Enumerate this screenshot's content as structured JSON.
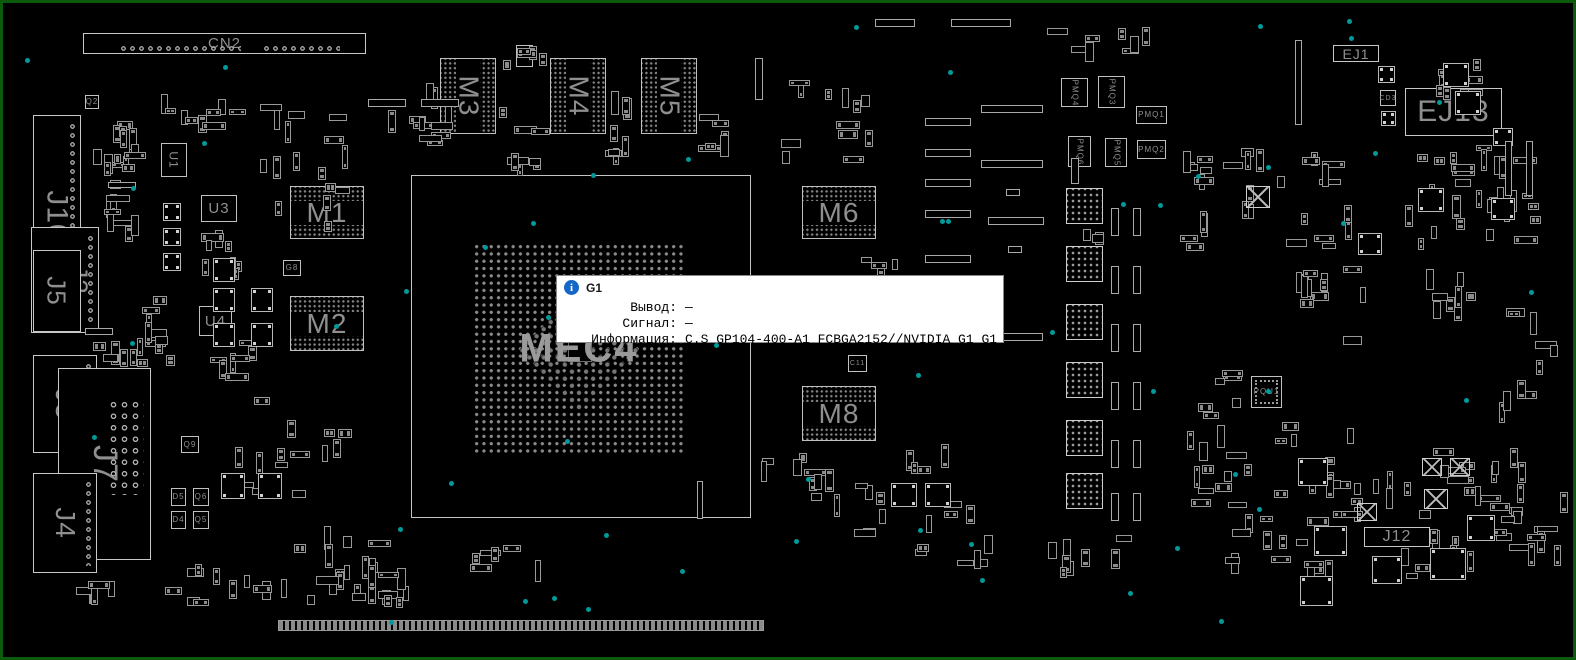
{
  "window": {
    "background": "#000000",
    "border_color": "#0c5a0c",
    "outline_color": "#b8b8b8",
    "label_color": "#8f8f8f",
    "testpoint_color": "#009a9a"
  },
  "tooltip": {
    "icon": "info-icon",
    "icon_glyph": "i",
    "icon_color": "#1467c6",
    "component": "G1",
    "rows": [
      {
        "label": "Вывод:",
        "value": "—"
      },
      {
        "label": "Сигнал:",
        "value": "—"
      },
      {
        "label": "Информация:",
        "value": "C.S GP104-400-A1 FCBGA2152//NVIDIA G1 G1"
      }
    ]
  },
  "gpu": {
    "ref": "G1",
    "die_label": "MEC4"
  },
  "components": [
    {
      "id": "CN2",
      "label": "CN2",
      "type": "connector",
      "x": 80,
      "y": 30,
      "w": 283,
      "h": 21,
      "fs": 15,
      "pins": "cn2"
    },
    {
      "id": "J10",
      "label": "J10",
      "type": "connector-v",
      "x": 30,
      "y": 112,
      "w": 48,
      "h": 202,
      "fs": 30,
      "pincol": 1
    },
    {
      "id": "J2",
      "label": "J2",
      "type": "connector-v",
      "x": 28,
      "y": 224,
      "w": 68,
      "h": 106,
      "fs": 26,
      "dx": 14,
      "pincol": 1
    },
    {
      "id": "J5",
      "label": "J5",
      "type": "connector-v",
      "x": 30,
      "y": 247,
      "w": 48,
      "h": 82,
      "fs": 26
    },
    {
      "id": "J3",
      "label": "J3",
      "type": "connector-v",
      "x": 30,
      "y": 352,
      "w": 64,
      "h": 98,
      "fs": 28,
      "pincol": 1
    },
    {
      "id": "J7",
      "label": "J7",
      "type": "connector-v",
      "x": 55,
      "y": 365,
      "w": 93,
      "h": 192,
      "fs": 34,
      "pingrid": 1
    },
    {
      "id": "J4",
      "label": "J4",
      "type": "connector-v",
      "x": 30,
      "y": 470,
      "w": 64,
      "h": 100,
      "fs": 28,
      "pincol": 1
    },
    {
      "id": "U1",
      "label": "U1",
      "type": "chip-v",
      "x": 158,
      "y": 140,
      "w": 26,
      "h": 34,
      "fs": 12
    },
    {
      "id": "U3",
      "label": "U3",
      "type": "chip",
      "x": 198,
      "y": 192,
      "w": 36,
      "h": 27,
      "fs": 15
    },
    {
      "id": "U4",
      "label": "U4",
      "type": "chip",
      "x": 196,
      "y": 303,
      "w": 33,
      "h": 30,
      "fs": 15
    },
    {
      "id": "M1",
      "label": "M1",
      "type": "bga",
      "x": 287,
      "y": 183,
      "w": 74,
      "h": 53,
      "fs": 28
    },
    {
      "id": "M2",
      "label": "M2",
      "type": "bga",
      "x": 287,
      "y": 293,
      "w": 74,
      "h": 55,
      "fs": 28
    },
    {
      "id": "M3",
      "label": "M3",
      "type": "bga-v",
      "x": 437,
      "y": 55,
      "w": 56,
      "h": 76,
      "fs": 28
    },
    {
      "id": "M4",
      "label": "M4",
      "type": "bga-v",
      "x": 547,
      "y": 55,
      "w": 56,
      "h": 76,
      "fs": 28
    },
    {
      "id": "M5",
      "label": "M5",
      "type": "bga-v",
      "x": 638,
      "y": 55,
      "w": 56,
      "h": 76,
      "fs": 28
    },
    {
      "id": "M6",
      "label": "M6",
      "type": "bga",
      "x": 799,
      "y": 183,
      "w": 74,
      "h": 53,
      "fs": 28
    },
    {
      "id": "M8",
      "label": "M8",
      "type": "bga",
      "x": 799,
      "y": 383,
      "w": 74,
      "h": 55,
      "fs": 28
    },
    {
      "id": "EJ1",
      "label": "EJ1",
      "type": "connector",
      "x": 1330,
      "y": 42,
      "w": 46,
      "h": 17,
      "fs": 14
    },
    {
      "id": "EJ13",
      "label": "EJ13",
      "type": "connector",
      "x": 1402,
      "y": 85,
      "w": 97,
      "h": 48,
      "fs": 30
    },
    {
      "id": "J12",
      "label": "J12",
      "type": "connector",
      "x": 1361,
      "y": 524,
      "w": 66,
      "h": 20,
      "fs": 16
    },
    {
      "id": "PMQ4",
      "label": "PMQ4",
      "type": "chip-v",
      "x": 1058,
      "y": 75,
      "w": 27,
      "h": 29,
      "fs": 8
    },
    {
      "id": "PMQ3",
      "label": "PMQ3",
      "type": "chip-v",
      "x": 1095,
      "y": 73,
      "w": 27,
      "h": 32,
      "fs": 8
    },
    {
      "id": "PMQ1",
      "label": "PMQ1",
      "type": "chip",
      "x": 1133,
      "y": 103,
      "w": 31,
      "h": 18,
      "fs": 8
    },
    {
      "id": "PMQ2",
      "label": "PMQ2",
      "type": "chip",
      "x": 1134,
      "y": 137,
      "w": 29,
      "h": 19,
      "fs": 8
    },
    {
      "id": "PMQ6",
      "label": "PMQ6",
      "type": "chip-v",
      "x": 1065,
      "y": 133,
      "w": 23,
      "h": 31,
      "fs": 8
    },
    {
      "id": "PMQ5",
      "label": "PMQ5",
      "type": "chip-v",
      "x": 1102,
      "y": 135,
      "w": 22,
      "h": 29,
      "fs": 8
    },
    {
      "id": "PQU1",
      "label": "PQU1",
      "type": "qfn",
      "x": 1248,
      "y": 373,
      "w": 31,
      "h": 32,
      "fs": 8
    },
    {
      "id": "G8",
      "label": "G8",
      "type": "small",
      "x": 280,
      "y": 257,
      "w": 18,
      "h": 16,
      "fs": 8
    },
    {
      "id": "G10",
      "label": "G10",
      "type": "small",
      "x": 513,
      "y": 42,
      "w": 17,
      "h": 22,
      "fs": 7
    },
    {
      "id": "C11",
      "label": "C11",
      "type": "small",
      "x": 845,
      "y": 352,
      "w": 19,
      "h": 17,
      "fs": 7
    },
    {
      "id": "CD3",
      "label": "CD3",
      "type": "small",
      "x": 1377,
      "y": 87,
      "w": 16,
      "h": 16,
      "fs": 7
    },
    {
      "id": "Q2",
      "label": "Q2",
      "type": "small",
      "x": 82,
      "y": 92,
      "w": 14,
      "h": 14,
      "fs": 8
    },
    {
      "id": "Q9",
      "label": "Q9",
      "type": "small",
      "x": 178,
      "y": 433,
      "w": 18,
      "h": 17,
      "fs": 8
    },
    {
      "id": "D5",
      "label": "D5",
      "type": "small",
      "x": 168,
      "y": 485,
      "w": 15,
      "h": 18,
      "fs": 8
    },
    {
      "id": "Q6",
      "label": "Q6",
      "type": "small",
      "x": 190,
      "y": 485,
      "w": 16,
      "h": 18,
      "fs": 8
    },
    {
      "id": "D4",
      "label": "D4",
      "type": "small",
      "x": 168,
      "y": 508,
      "w": 15,
      "h": 18,
      "fs": 8
    },
    {
      "id": "Q5",
      "label": "Q5",
      "type": "small",
      "x": 190,
      "y": 508,
      "w": 16,
      "h": 18,
      "fs": 8
    }
  ],
  "gpu_geometry": {
    "x": 408,
    "y": 172,
    "w": 340,
    "h": 343,
    "grid": {
      "x": 470,
      "y": 240,
      "w": 212,
      "h": 212
    }
  }
}
